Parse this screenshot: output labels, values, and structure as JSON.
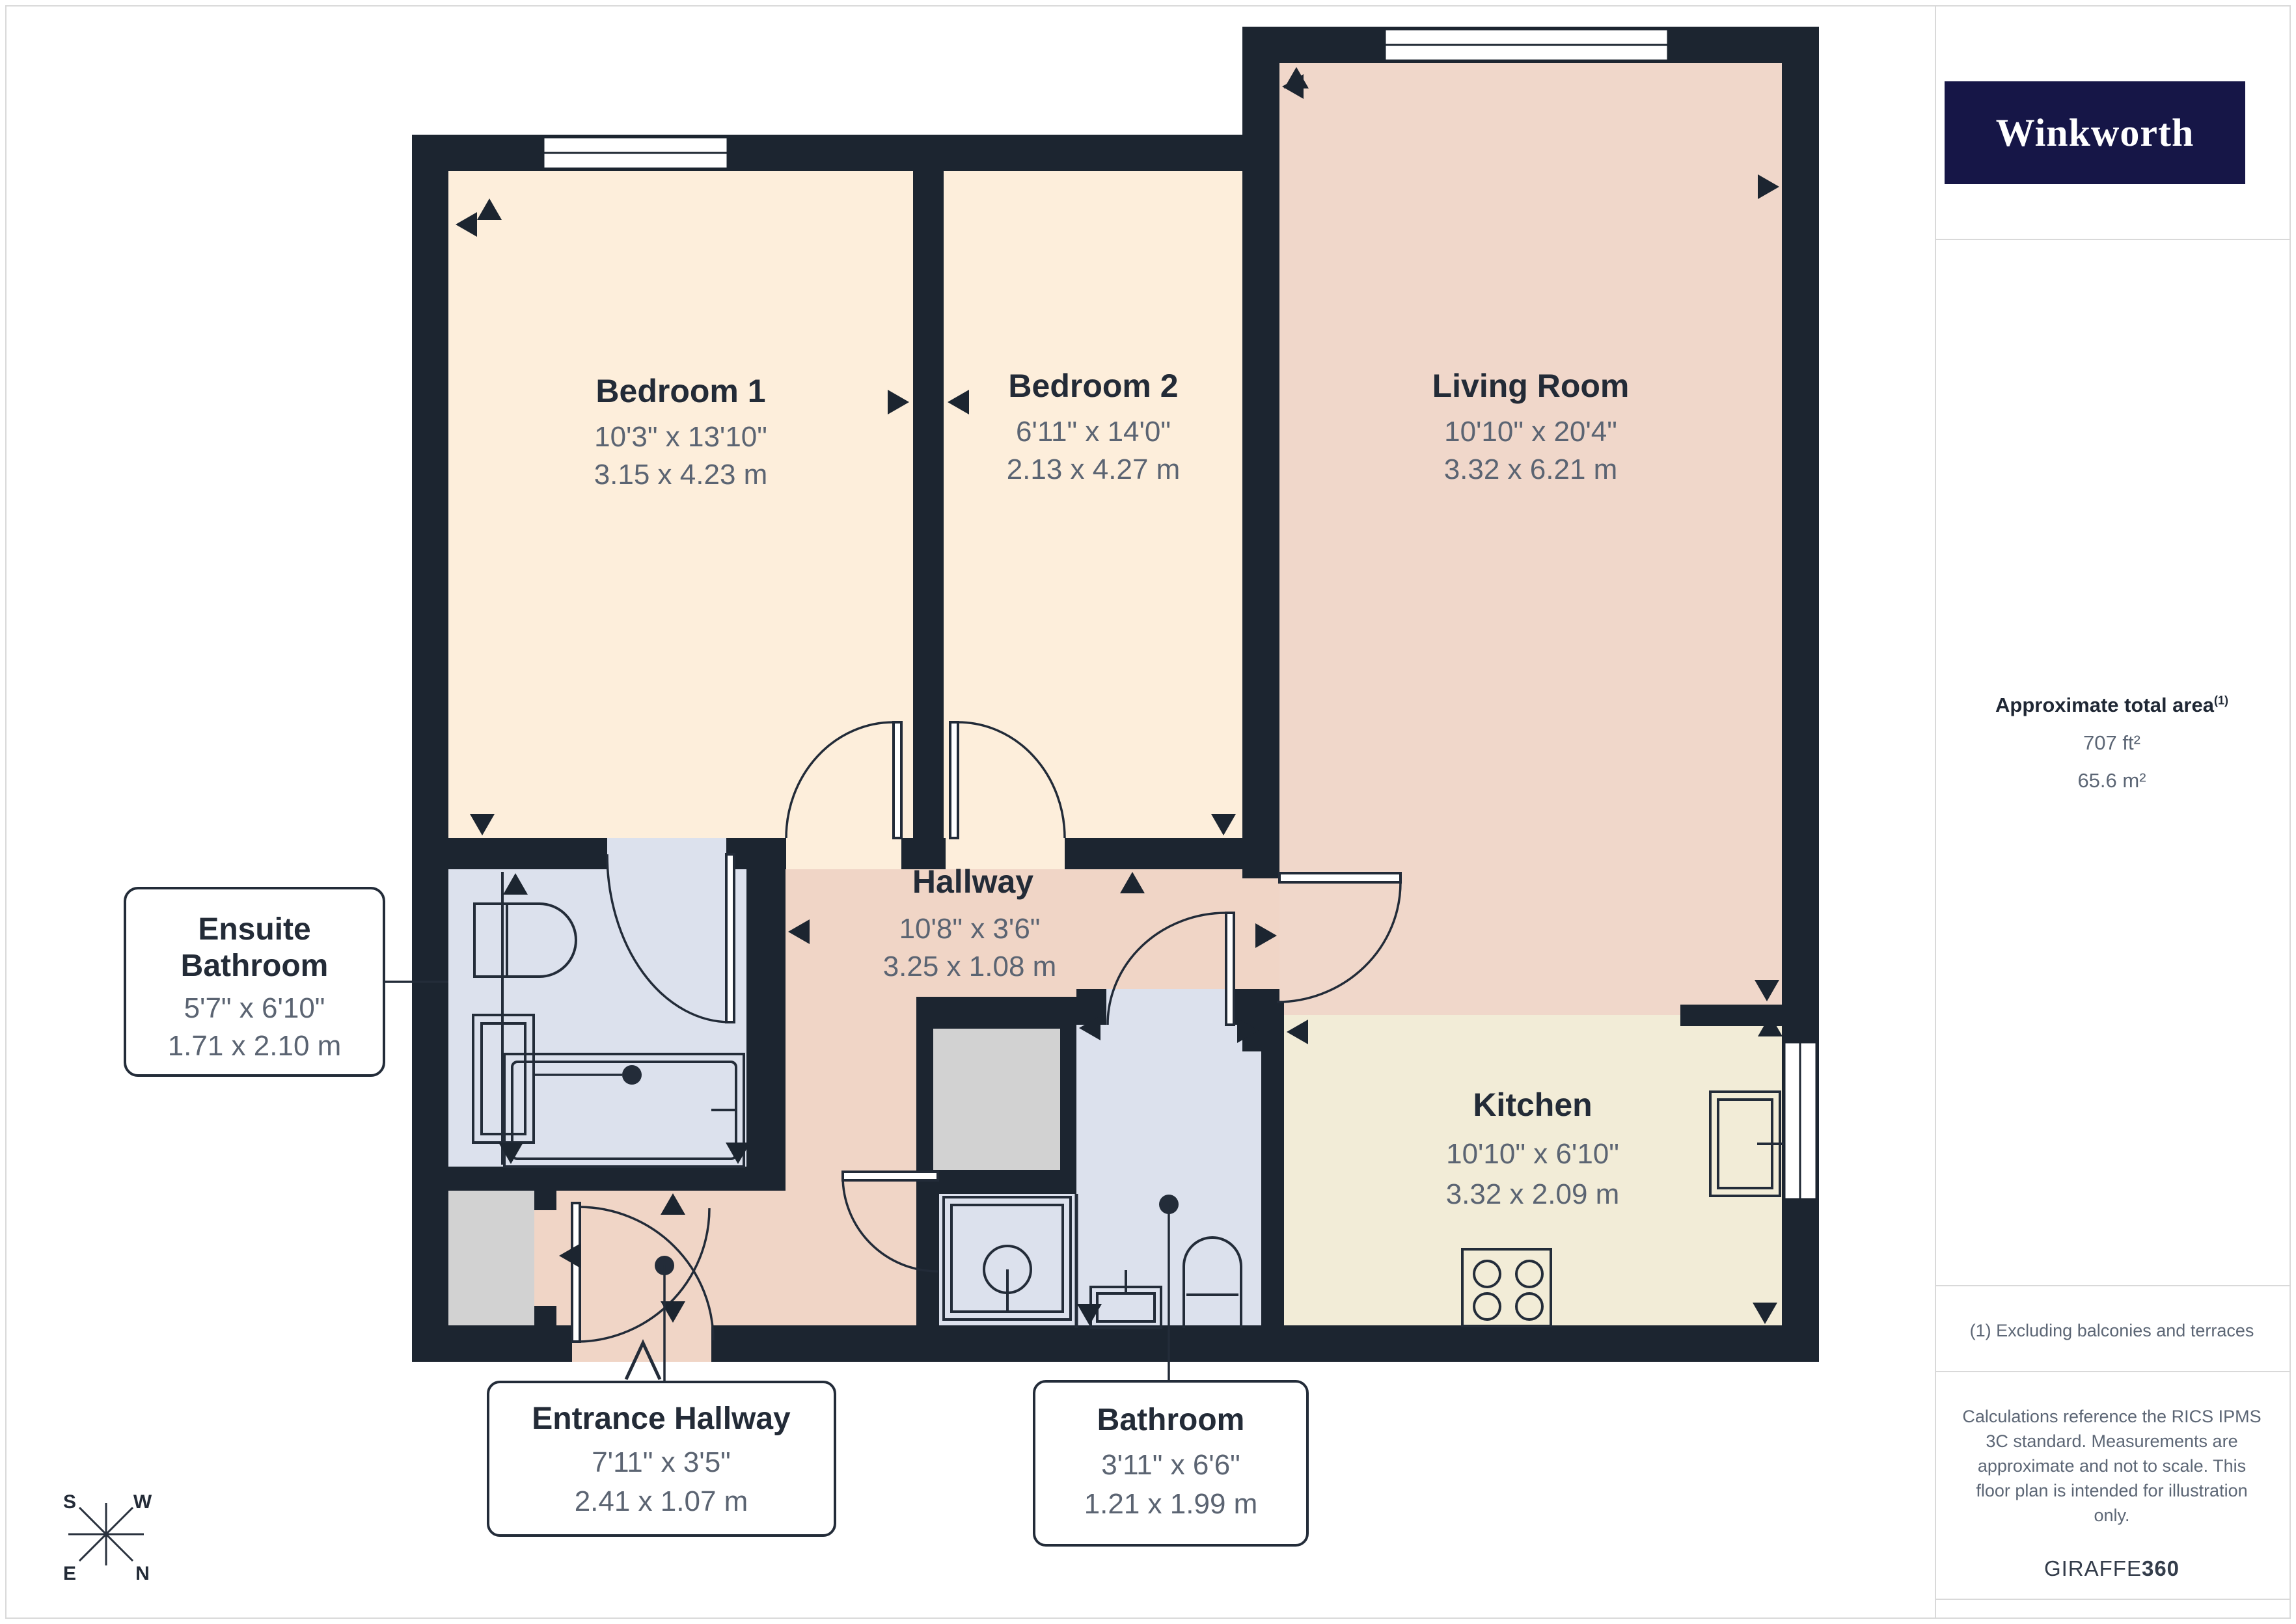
{
  "sidebar": {
    "brand": "Winkworth",
    "area_label": "Approximate total area",
    "area_footnote_marker": "(1)",
    "area_imperial": "707 ft²",
    "area_metric": "65.6 m²",
    "footnote": "(1) Excluding balconies and terraces",
    "disclaimer_lines": [
      "Calculations reference the RICS IPMS",
      "3C standard. Measurements are",
      "approximate and not to scale. This",
      "floor plan is intended for illustration",
      "only."
    ],
    "credit_prefix": "GIRAFFE",
    "credit_suffix": "360"
  },
  "rooms": [
    {
      "name": "Bedroom 1",
      "imperial": "10'3\" x 13'10\"",
      "metric": "3.15 x 4.23 m"
    },
    {
      "name": "Bedroom 2",
      "imperial": "6'11\" x 14'0\"",
      "metric": "2.13 x 4.27 m"
    },
    {
      "name": "Living Room",
      "imperial": "10'10\" x 20'4\"",
      "metric": "3.32 x 6.21 m"
    },
    {
      "name": "Hallway",
      "imperial": "10'8\" x 3'6\"",
      "metric": "3.25 x 1.08 m"
    },
    {
      "name": "Kitchen",
      "imperial": "10'10\" x 6'10\"",
      "metric": "3.32 x 2.09 m"
    },
    {
      "name_line1": "Ensuite",
      "name_line2": "Bathroom",
      "imperial": "5'7\" x 6'10\"",
      "metric": "1.71 x 2.10 m"
    },
    {
      "name": "Entrance Hallway",
      "imperial": "7'11\" x 3'5\"",
      "metric": "2.41 x 1.07 m"
    },
    {
      "name": "Bathroom",
      "imperial": "3'11\" x 6'6\"",
      "metric": "1.21 x 1.99 m"
    }
  ],
  "compass": {
    "top_left": "S",
    "top_right": "W",
    "bottom_left": "E",
    "bottom_right": "N"
  },
  "colors": {
    "wall": "#1c2530",
    "floor_bedroom": "#fdeedb",
    "floor_living": "#f0d7ca",
    "floor_hallway": "#f0d5c6",
    "floor_kitchen": "#f2ecd7",
    "floor_bathroom": "#dce1ed",
    "floor_storage": "#d2d2d2",
    "label_title": "#232b37",
    "label_dims": "#5b6472",
    "brand_navy": "#161647"
  }
}
